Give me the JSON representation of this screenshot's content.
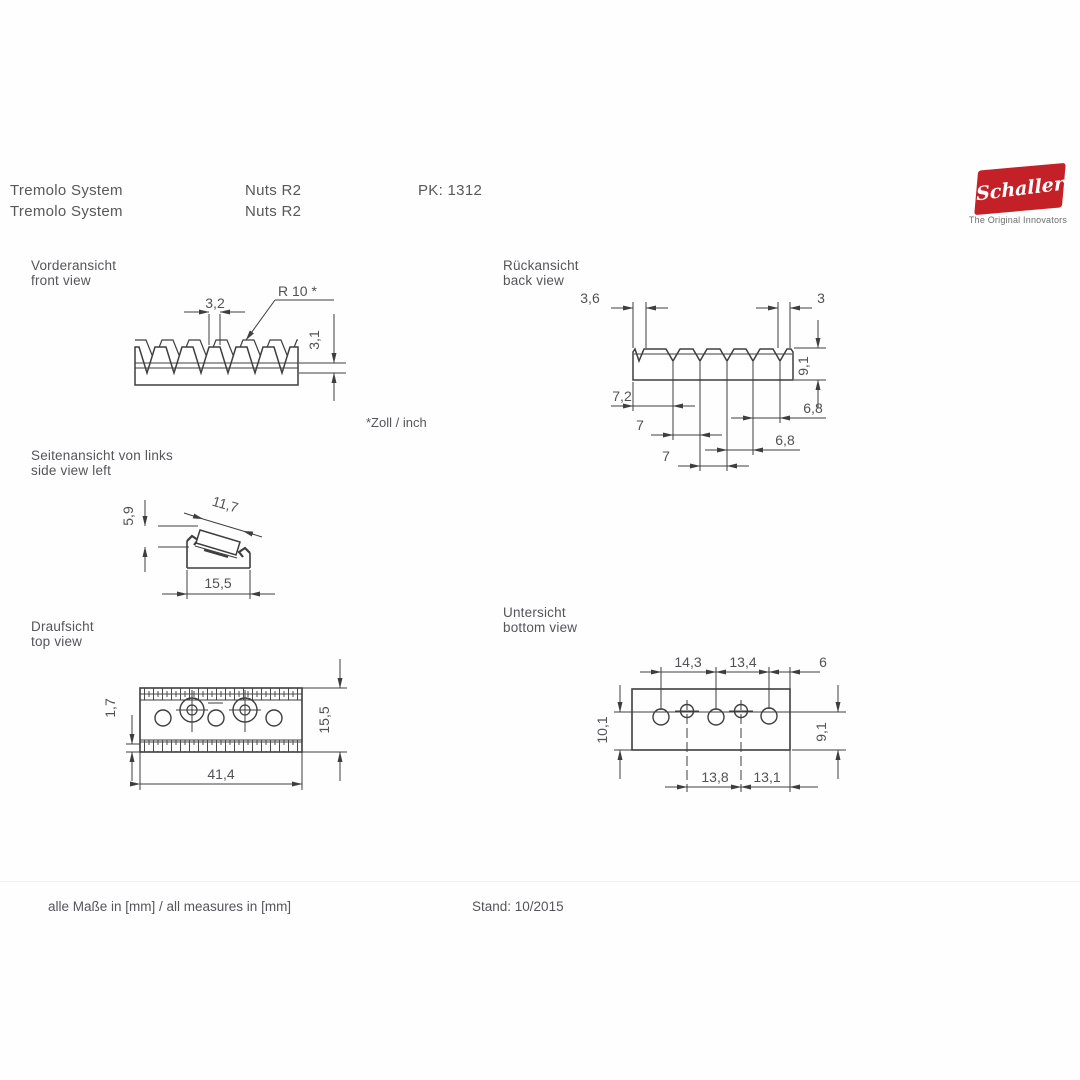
{
  "header": {
    "product": "Tremolo System",
    "product2": "Tremolo System",
    "model": "Nuts R2",
    "model2": "Nuts R2",
    "pk": "PK: 1312"
  },
  "logo": {
    "brand": "Schaller",
    "tagline": "The Original Innovators",
    "brand_color": "#c32127"
  },
  "views": {
    "front": {
      "label": "Vorderansicht\nfront view",
      "dim_pitch": "3,2",
      "dim_radius": "R 10 *",
      "dim_depth": "3,1",
      "footnote": "*Zoll / inch"
    },
    "back": {
      "label": "Rückansicht\nback view",
      "dim_groove_wide": "3,6",
      "dim_groove_narrow": "3",
      "dim_height": "9,1",
      "dim_s1": "7,2",
      "dim_s2": "7",
      "dim_s3": "7",
      "dim_s4": "6,8",
      "dim_s5": "6,8"
    },
    "side": {
      "label": "Seitenansicht von links\nside view left",
      "dim_height": "5,9",
      "dim_top": "11,7",
      "dim_width": "15,5"
    },
    "top": {
      "label": "Draufsicht\ntop view",
      "dim_edge": "1,7",
      "dim_depth": "15,5",
      "dim_length": "41,4"
    },
    "bottom": {
      "label": "Untersicht\nbottom view",
      "dim_t1": "14,3",
      "dim_t2": "13,4",
      "dim_t3": "6",
      "dim_left": "10,1",
      "dim_right": "9,1",
      "dim_b1": "13,8",
      "dim_b2": "13,1"
    }
  },
  "footer": {
    "units": "alle Maße in [mm] / all measures in [mm]",
    "revision": "Stand: 10/2015"
  }
}
